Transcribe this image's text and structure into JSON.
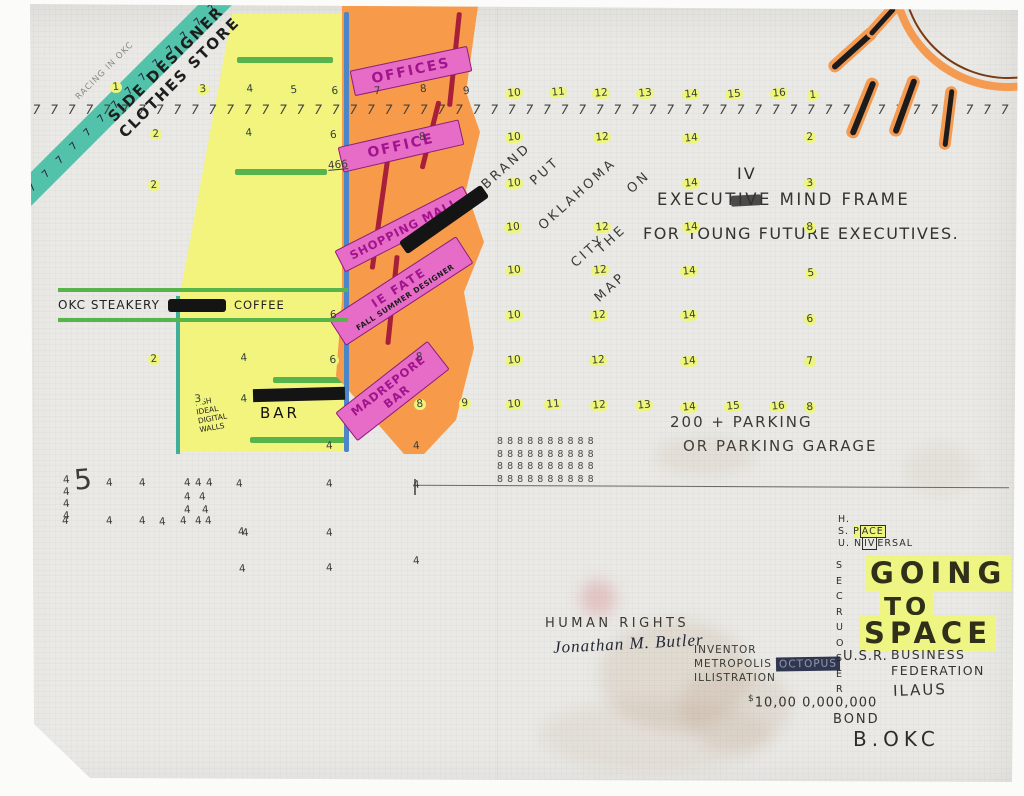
{
  "colors": {
    "paper": "#eae9e5",
    "teal_banner": "#52c2aa",
    "yellow_building": "#f2f47e",
    "orange_building": "#f79a4a",
    "pink_band": "#e76cc8",
    "magenta_letters": "#a0148c",
    "green_band": "#57b44a",
    "blue_outline": "#4a86c8",
    "crimson_line": "#a81f3a",
    "number_highlight": "#edf57d",
    "sun_orange": "#f59b51",
    "ink": "#3a3a35"
  },
  "banner": {
    "tally": "7 7 7 7 7 7 7 7 7 7 7 7 7 7 7 7 7 7",
    "line1": "SIDE DESIGNER",
    "line2": "CLOTHES STORE",
    "pencil_note": "RACING IN OKC"
  },
  "ruler": {
    "tally": "7 7 7 7 7 7 7 7 7 7 7 7 7 7 7 7 7 7 7 7 7 7 7 7 7 7 7 7 7 7 7 7 7 7 7 7 7 7 7 7 7 7 7 7 7 7 7 7 7 7 7 7 7 7 7 7 7 7 7 7 7 7"
  },
  "building": {
    "bands": [
      {
        "label": "OFFICES"
      },
      {
        "label": "OFFICE"
      },
      {
        "label": "SHOPPING MALL"
      },
      {
        "label": "IE FATE",
        "sub": "FALL SUMMER DESIGNER"
      },
      {
        "label": "MADREPORE",
        "sub": "BAR"
      }
    ],
    "steakery": "OKC STEAKERY",
    "coffee": "COFFEE",
    "bar": "BAR",
    "fish_note": "FISH\nIDEAL\nDIGITAL\nWALLS"
  },
  "slogan": {
    "words": [
      "BRAND",
      "PUT",
      "OKLAHOMA",
      "CITY",
      "ON",
      "THE",
      "MAP"
    ]
  },
  "executive": {
    "sup": "IV",
    "line1": "EXECUTIVE MIND FRAME",
    "line2": "FOR YOUNG FUTURE EXECUTIVES."
  },
  "parking": {
    "line1": "200 + PARKING",
    "line2": "OR PARKING GARAGE"
  },
  "eights": "8 8 8 8  8 8 8  8 8  8\n8 8 8 8  8 8 8  8 8  8\n8 8 8 8  8 8 8  8 8  8\n8 8 8 8  8 8 8  8 8  8",
  "footer": {
    "hsu": [
      "H.",
      "S.",
      "U."
    ],
    "space": {
      "pre": "P",
      "boxed": "ACE"
    },
    "universal": {
      "pre": "N",
      "boxed": "IV",
      "post": "ERSAL"
    },
    "vertical_word": "S\nE\nC\nR\nU\nO\nS\nE\nR",
    "space_slogan": [
      "GOING",
      "TO",
      "SPACE"
    ],
    "human_rights": "HUMAN RIGHTS",
    "signature": "Jonathan M. Butler",
    "inventor": "INVENTOR",
    "metropolis": "METROPOLIS",
    "octopus": "OCTOPUS",
    "illustration": "ILLISTRATION",
    "usr": "U.S.R.",
    "business": "BUSINESS",
    "federation": "FEDERATION",
    "ilaus": "ILAUS",
    "currency": "$",
    "amount": "10,00 0,000,000",
    "bond": "BOND",
    "bokc": "B.OKC"
  },
  "numbers": [
    {
      "t": "1",
      "x": 110,
      "y": 82,
      "hl": true
    },
    {
      "t": "3",
      "x": 197,
      "y": 84,
      "hl": true
    },
    {
      "t": "4",
      "x": 244,
      "y": 84,
      "hl": true
    },
    {
      "t": "5",
      "x": 288,
      "y": 85,
      "hl": true
    },
    {
      "t": "6",
      "x": 329,
      "y": 86,
      "hl": true
    },
    {
      "t": "7",
      "x": 374,
      "y": 86,
      "hl": false
    },
    {
      "t": "8",
      "x": 420,
      "y": 84,
      "hl": false
    },
    {
      "t": "9",
      "x": 463,
      "y": 86,
      "hl": false
    },
    {
      "t": "10",
      "x": 505,
      "y": 88,
      "hl": true
    },
    {
      "t": "11",
      "x": 549,
      "y": 87,
      "hl": true
    },
    {
      "t": "12",
      "x": 592,
      "y": 88,
      "hl": true
    },
    {
      "t": "13",
      "x": 636,
      "y": 88,
      "hl": true
    },
    {
      "t": "14",
      "x": 682,
      "y": 89,
      "hl": true
    },
    {
      "t": "15",
      "x": 725,
      "y": 89,
      "hl": true
    },
    {
      "t": "16",
      "x": 770,
      "y": 88,
      "hl": true
    },
    {
      "t": "1",
      "x": 807,
      "y": 90,
      "hl": true
    },
    {
      "t": "2",
      "x": 150,
      "y": 129,
      "hl": true
    },
    {
      "t": "4",
      "x": 243,
      "y": 128,
      "hl": true
    },
    {
      "t": "6",
      "x": 330,
      "y": 130,
      "hl": false
    },
    {
      "t": "8",
      "x": 419,
      "y": 132,
      "hl": false
    },
    {
      "t": "10",
      "x": 505,
      "y": 132,
      "hl": true
    },
    {
      "t": "12",
      "x": 593,
      "y": 132,
      "hl": true
    },
    {
      "t": "14",
      "x": 682,
      "y": 133,
      "hl": true
    },
    {
      "t": "2",
      "x": 804,
      "y": 132,
      "hl": true
    },
    {
      "t": "10",
      "x": 505,
      "y": 178,
      "hl": true
    },
    {
      "t": "10",
      "x": 504,
      "y": 222,
      "hl": true
    },
    {
      "t": "10",
      "x": 505,
      "y": 265,
      "hl": true
    },
    {
      "t": "10",
      "x": 505,
      "y": 310,
      "hl": true
    },
    {
      "t": "10",
      "x": 505,
      "y": 355,
      "hl": true
    },
    {
      "t": "12",
      "x": 593,
      "y": 222,
      "hl": true
    },
    {
      "t": "12",
      "x": 591,
      "y": 265,
      "hl": true
    },
    {
      "t": "12",
      "x": 590,
      "y": 310,
      "hl": true
    },
    {
      "t": "12",
      "x": 589,
      "y": 355,
      "hl": true
    },
    {
      "t": "14",
      "x": 682,
      "y": 178,
      "hl": true
    },
    {
      "t": "14",
      "x": 682,
      "y": 222,
      "hl": true
    },
    {
      "t": "14",
      "x": 680,
      "y": 266,
      "hl": true
    },
    {
      "t": "14",
      "x": 680,
      "y": 310,
      "hl": true
    },
    {
      "t": "14",
      "x": 680,
      "y": 356,
      "hl": true
    },
    {
      "t": "3",
      "x": 804,
      "y": 178,
      "hl": true
    },
    {
      "t": "8",
      "x": 804,
      "y": 222,
      "hl": true
    },
    {
      "t": "5",
      "x": 805,
      "y": 268,
      "hl": true
    },
    {
      "t": "6",
      "x": 804,
      "y": 314,
      "hl": true
    },
    {
      "t": "7",
      "x": 804,
      "y": 356,
      "hl": true
    },
    {
      "t": "8",
      "x": 414,
      "y": 399,
      "hl": true
    },
    {
      "t": "9",
      "x": 459,
      "y": 398,
      "hl": true
    },
    {
      "t": "10",
      "x": 505,
      "y": 399,
      "hl": true
    },
    {
      "t": "11",
      "x": 544,
      "y": 399,
      "hl": true
    },
    {
      "t": "12",
      "x": 590,
      "y": 400,
      "hl": true
    },
    {
      "t": "13",
      "x": 635,
      "y": 400,
      "hl": true
    },
    {
      "t": "14",
      "x": 680,
      "y": 402,
      "hl": true
    },
    {
      "t": "15",
      "x": 724,
      "y": 401,
      "hl": true
    },
    {
      "t": "16",
      "x": 769,
      "y": 401,
      "hl": true
    },
    {
      "t": "8",
      "x": 804,
      "y": 402,
      "hl": true
    },
    {
      "t": "2",
      "x": 148,
      "y": 180,
      "hl": true
    },
    {
      "t": "2",
      "x": 148,
      "y": 354,
      "hl": true
    },
    {
      "t": "4",
      "x": 238,
      "y": 353,
      "hl": true
    },
    {
      "t": "6",
      "x": 327,
      "y": 355,
      "hl": true
    },
    {
      "t": "3",
      "x": 192,
      "y": 394,
      "hl": true
    },
    {
      "t": "4",
      "x": 238,
      "y": 394,
      "hl": true
    },
    {
      "t": "6",
      "x": 330,
      "y": 310,
      "hl": false
    },
    {
      "t": "8",
      "x": 416,
      "y": 352,
      "hl": false
    },
    {
      "t": "4",
      "x": 326,
      "y": 441,
      "hl": false
    },
    {
      "t": "4",
      "x": 413,
      "y": 441,
      "hl": false
    },
    {
      "t": "466",
      "x": 328,
      "y": 160,
      "hl": false,
      "u": true
    },
    {
      "t": "5",
      "x": 74,
      "y": 474,
      "s": 28,
      "hl": false
    },
    {
      "t": "4",
      "x": 63,
      "y": 475,
      "hl": false
    },
    {
      "t": "4",
      "x": 63,
      "y": 487,
      "hl": false
    },
    {
      "t": "4",
      "x": 63,
      "y": 499,
      "hl": false
    },
    {
      "t": "4",
      "x": 63,
      "y": 511,
      "hl": false
    },
    {
      "t": "4",
      "x": 106,
      "y": 478,
      "hl": false
    },
    {
      "t": "4",
      "x": 139,
      "y": 478,
      "hl": false
    },
    {
      "t": "4",
      "x": 184,
      "y": 478,
      "hl": false
    },
    {
      "t": "4",
      "x": 195,
      "y": 478,
      "hl": false
    },
    {
      "t": "4",
      "x": 206,
      "y": 478,
      "hl": false
    },
    {
      "t": "4",
      "x": 236,
      "y": 479,
      "hl": false
    },
    {
      "t": "4",
      "x": 184,
      "y": 492,
      "hl": false
    },
    {
      "t": "4",
      "x": 199,
      "y": 492,
      "hl": false
    },
    {
      "t": "4",
      "x": 184,
      "y": 505,
      "hl": false
    },
    {
      "t": "4",
      "x": 202,
      "y": 505,
      "hl": false
    },
    {
      "t": "4",
      "x": 62,
      "y": 516,
      "hl": false
    },
    {
      "t": "4",
      "x": 106,
      "y": 516,
      "hl": false
    },
    {
      "t": "4",
      "x": 139,
      "y": 516,
      "hl": false
    },
    {
      "t": "4",
      "x": 159,
      "y": 517,
      "hl": false
    },
    {
      "t": "4",
      "x": 180,
      "y": 516,
      "hl": false
    },
    {
      "t": "4",
      "x": 195,
      "y": 516,
      "hl": false
    },
    {
      "t": "4",
      "x": 205,
      "y": 516,
      "hl": false
    },
    {
      "t": "4",
      "x": 238,
      "y": 527,
      "hl": false
    },
    {
      "t": "4",
      "x": 326,
      "y": 479,
      "hl": false
    },
    {
      "t": "4",
      "x": 413,
      "y": 480,
      "hl": false
    },
    {
      "t": "4",
      "x": 242,
      "y": 528,
      "hl": false
    },
    {
      "t": "4",
      "x": 326,
      "y": 528,
      "hl": false
    },
    {
      "t": "4",
      "x": 239,
      "y": 564,
      "hl": false
    },
    {
      "t": "4",
      "x": 326,
      "y": 563,
      "hl": false
    },
    {
      "t": "4",
      "x": 413,
      "y": 556,
      "hl": false
    }
  ]
}
